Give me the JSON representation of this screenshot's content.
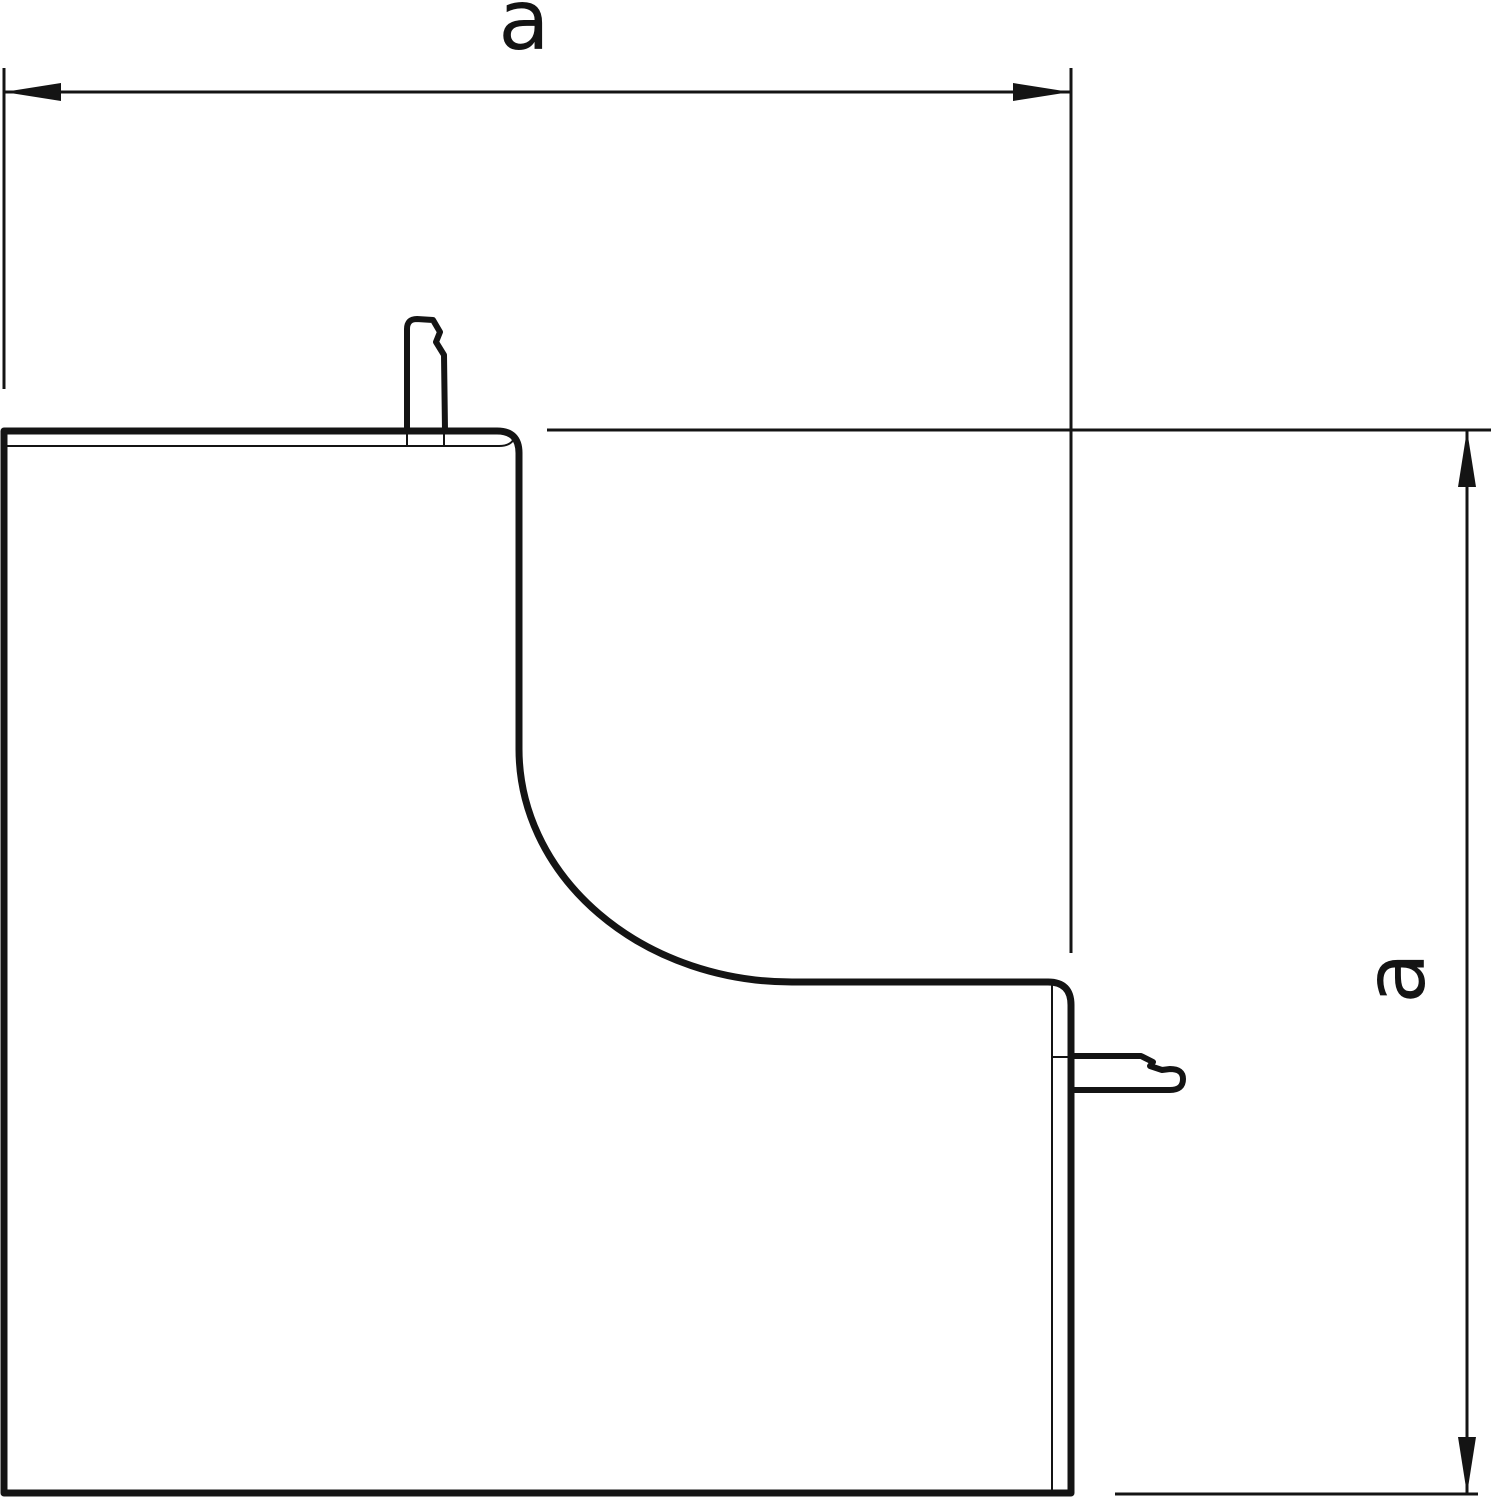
{
  "drawing": {
    "dimension_labels": {
      "width": "a",
      "height": "a"
    },
    "colors": {
      "line": "#141414",
      "background": "#ffffff"
    }
  }
}
